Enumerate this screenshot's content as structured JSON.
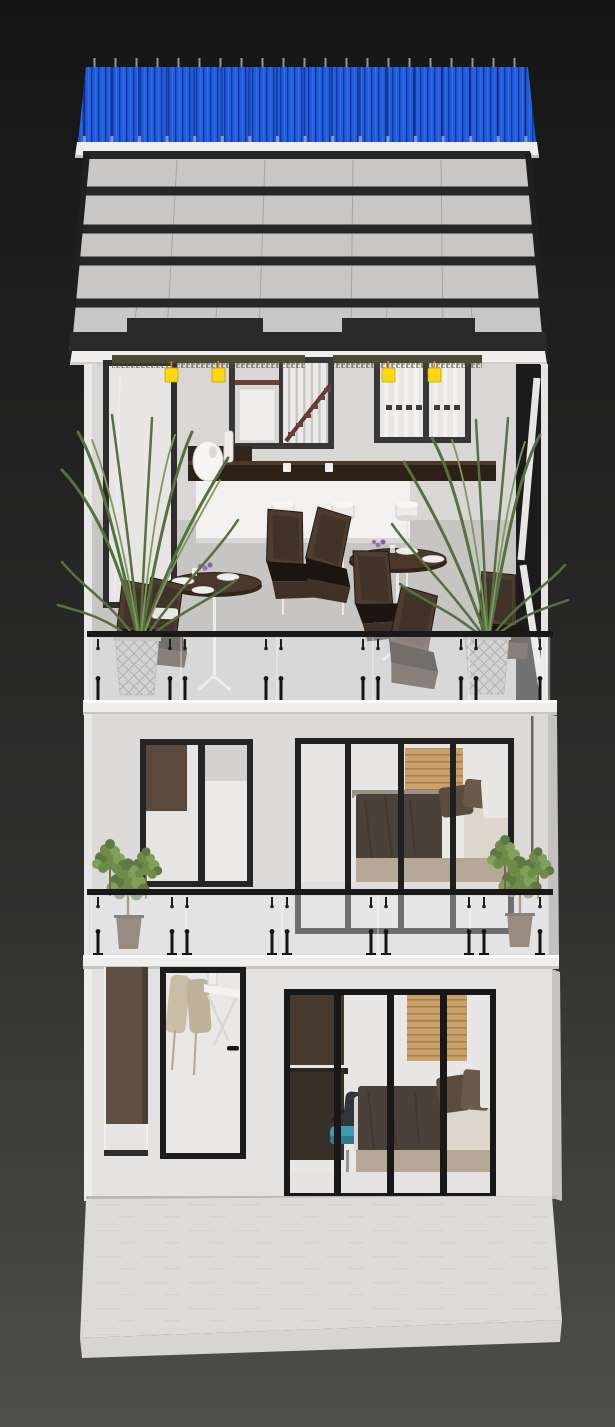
{
  "scene": {
    "description": "3D architectural render of a narrow three-storey house, front elevation, on a dark viewport gradient background",
    "floors": [
      {
        "name": "rooftop-terrace",
        "features": [
          "blue corrugated metal roof",
          "sloped glazed canopy with dark beams",
          "stair window",
          "bar counter with egg lamp",
          "two round dining tables with plates and flowers",
          "dark wicker chairs",
          "two faceted palm planters",
          "four yellow hanging lanterns",
          "three white table lamps",
          "glass balustrade with black clamps"
        ]
      },
      {
        "name": "middle-bedroom-floor",
        "features": [
          "two-pane window",
          "four-pane glass wall",
          "double bed with dark throw and pillows",
          "wood slat headboard panel",
          "two potted balcony plants",
          "glass balustrade"
        ]
      },
      {
        "name": "ground-floor",
        "features": [
          "open doorway with brown panel",
          "black framed glass entry door with dining chairs behind",
          "four-pane bedroom glass wall",
          "desk with teal office chair",
          "double bed",
          "stone forecourt slab"
        ]
      }
    ]
  },
  "counts": {
    "visible_floors": 3,
    "hanging_lanterns": 4,
    "table_lamps": 3,
    "dining_tables": 2,
    "palm_planters": 2,
    "balcony_plants": 2,
    "glass_balustrades": 2
  },
  "colors": {
    "background_top": "#151515",
    "background_bottom": "#4e4e4c",
    "roof_blue": "#1f5ce0",
    "fascia_white": "#efeeec",
    "attic_panel": "#c8c7c5",
    "beam_dark": "#262626",
    "wall_terrace": "#d8d7d5",
    "wall_middle": "#dbdad8",
    "wall_ground": "#e3e2e0",
    "floor_concrete": "#c6c5c3",
    "frame_dark": "#232323",
    "glass_tint": "#e7e6e4",
    "counter_brown": "#2c2017",
    "bar_front_white": "#f2f1ef",
    "lantern_yellow": "#ffd712",
    "vine_green": "#4c4a35",
    "palm_green": "#55713f",
    "palm_green_light": "#7e9a5e",
    "chair_wicker": "#4e3c30",
    "chair_seat_dark": "#1c1510",
    "table_wood": "#4a382b",
    "planter_gray": "#bdbdbb",
    "slat_wood": "#c9a26b",
    "bed_blanket": "#4a423a",
    "pillow_brown": "#5a4c40",
    "bed_base": "#b5a896",
    "mattress_white": "#dcd6cc",
    "office_chair_teal": "#3f9aae",
    "door_interior_brown": "#5f5044",
    "stair_rail_red": "#6e4038",
    "slab_white": "#efeeec",
    "railing_black": "#191919"
  }
}
